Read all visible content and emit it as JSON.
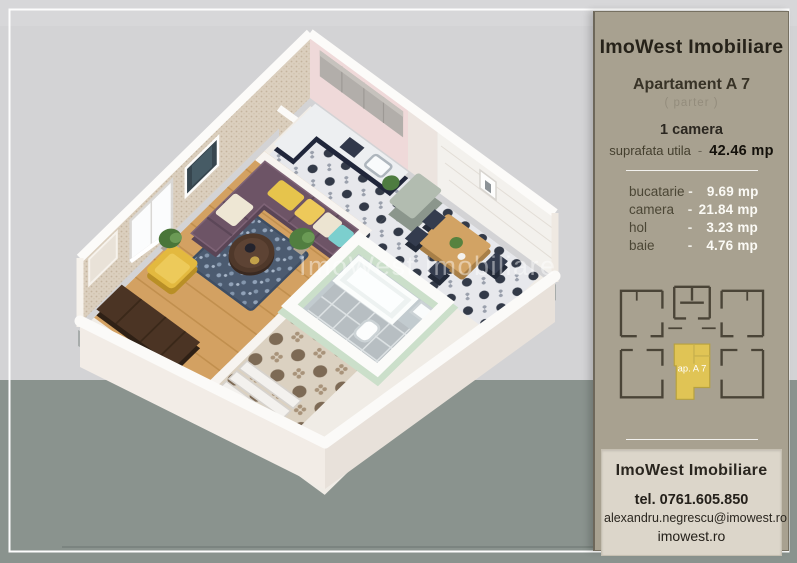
{
  "watermark": {
    "text": "ImoWest Imobiliare"
  },
  "panel": {
    "brand": "ImoWest Imobiliare",
    "apartment_title": "Apartament A 7",
    "floor_note": "( parter )",
    "rooms_count": "1 camera",
    "area_label": "suprafata utila",
    "area_dash": "-",
    "area_value": "42.46 mp",
    "rooms": [
      {
        "name": "bucatarie",
        "dash": "-",
        "area": "9.69 mp"
      },
      {
        "name": "camera",
        "dash": "-",
        "area": "21.84 mp"
      },
      {
        "name": "hol",
        "dash": "-",
        "area": "3.23 mp"
      },
      {
        "name": "baie",
        "dash": "-",
        "area": "4.76 mp"
      }
    ],
    "plan_label": "ap. A 7",
    "contact": {
      "brand": "ImoWest Imobiliare",
      "phone": "tel. 0761.605.850",
      "email": "alexandru.negrescu@imowest.ro",
      "website": "imowest.ro"
    }
  },
  "colors": {
    "background_top": "#d3d3d5",
    "background_bottom": "#8a938e",
    "panel_background": "#a8a190",
    "contact_background": "#dcd6ca",
    "highlight_yellow": "#e0c455",
    "sofa_purple": "#6d5466",
    "armchair_yellow": "#e3b93f",
    "bathroom_mint": "#cbdfca",
    "kitchen_pink": "#efd9d9"
  }
}
